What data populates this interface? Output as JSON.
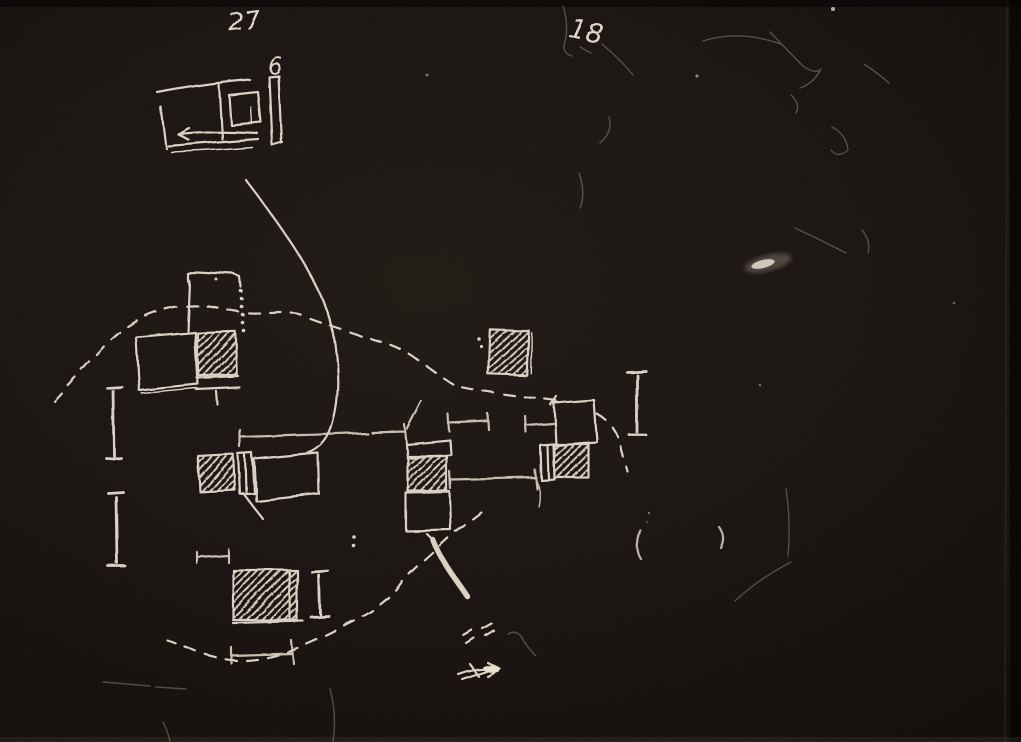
{
  "page": {
    "kind": "hand-drawn architectural site-plan sketch, white chalk ink on black paper",
    "background_color": "#171210",
    "ink_color": "#d8d2c4",
    "width": 1021,
    "height": 742
  },
  "labels": {
    "page_number": "27",
    "plan_label": "6",
    "sheet_label": "18"
  },
  "sketch_inventory": {
    "detail_plan": "small rectangular floor plan with inner square, right wall bar and leftward arrow (top left)",
    "leader_curve": "long curved line from detail plan down to plan cluster",
    "boundary": "dashed kidney-shaped site boundary around building cluster",
    "hatched_blocks_count": 6,
    "outline_buildings_count": 5,
    "section_markers_I_count": 4,
    "dimension_tick_lines_count": 6,
    "misc_marks": [
      "bold curved arrow",
      "scribbled arrow",
      "double-dash pairs",
      "colon dots",
      "parenthesis marks",
      "paper scratches and smudges"
    ]
  }
}
